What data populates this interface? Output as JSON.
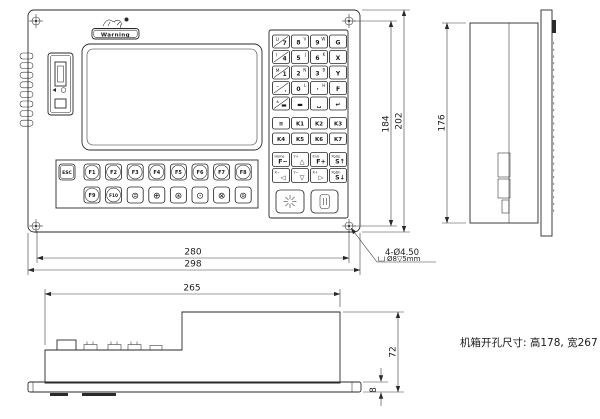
{
  "title": "CNC controller panel engineering drawing",
  "front_view": {
    "logo_text": "Warning",
    "fkeys_row1": [
      "ESC",
      "F1",
      "F2",
      "F3",
      "F4",
      "F5",
      "F6",
      "F7",
      "F8"
    ],
    "fkeys_row2": [
      "F9",
      "F10"
    ],
    "icon_keys": [
      "⊜",
      "⊕",
      "⊛",
      "⊙",
      "⊗",
      "⊚"
    ],
    "numpad": [
      {
        "main": "7",
        "sec": "U"
      },
      {
        "main": "8",
        "sec": "V"
      },
      {
        "main": "9",
        "sec": "W"
      },
      {
        "main": "G"
      },
      {
        "main": "4",
        "sec": "I"
      },
      {
        "main": "5",
        "sec": "J"
      },
      {
        "main": "6",
        "sec": "K"
      },
      {
        "main": "X"
      },
      {
        "main": "1",
        "sec": "M"
      },
      {
        "main": "2",
        "sec": "N"
      },
      {
        "main": "3",
        "sec": "B"
      },
      {
        "main": "Y"
      },
      {
        "main": ".",
        "sec": "−"
      },
      {
        "main": "0",
        "sec": "L"
      },
      {
        "main": "·",
        "sec": "H"
      },
      {
        "main": "F"
      },
      {
        "main": "▬",
        "sec": "±"
      },
      {
        "main": "▬"
      },
      {
        "main": "␣"
      },
      {
        "main": "↵"
      }
    ],
    "k_keys": [
      "≡",
      "K1",
      "K2",
      "K3",
      "K4",
      "K5",
      "K6",
      "K7"
    ],
    "arrow_keys": [
      {
        "main": "F−",
        "sec": "Home"
      },
      {
        "main": "△",
        "sec": "Y+"
      },
      {
        "main": "F+",
        "sec": "End"
      },
      {
        "main": "S↑",
        "sec": "PgUp"
      },
      {
        "main": "◁",
        "sec": "X−"
      },
      {
        "main": "▽",
        "sec": "Y−"
      },
      {
        "main": "▷",
        "sec": "X+"
      },
      {
        "main": "S↓",
        "sec": "PgDn"
      }
    ]
  },
  "dimensions": {
    "hole_spacing_width": "280",
    "overall_width": "298",
    "hole_spacing_height": "184",
    "overall_height": "202",
    "side_height": "176",
    "depth": "265",
    "total_thickness": "72",
    "panel_thickness": "8"
  },
  "notes": {
    "holes_line1": "4-Ø4.50",
    "holes_line2": "Ø8▽5mm",
    "cutout": "机箱开孔尺寸: 高178, 宽267"
  },
  "colors": {
    "line": "#2a2a2a",
    "dim": "#3a3a3a",
    "text": "#1a1a1a",
    "bg": "#ffffff"
  }
}
